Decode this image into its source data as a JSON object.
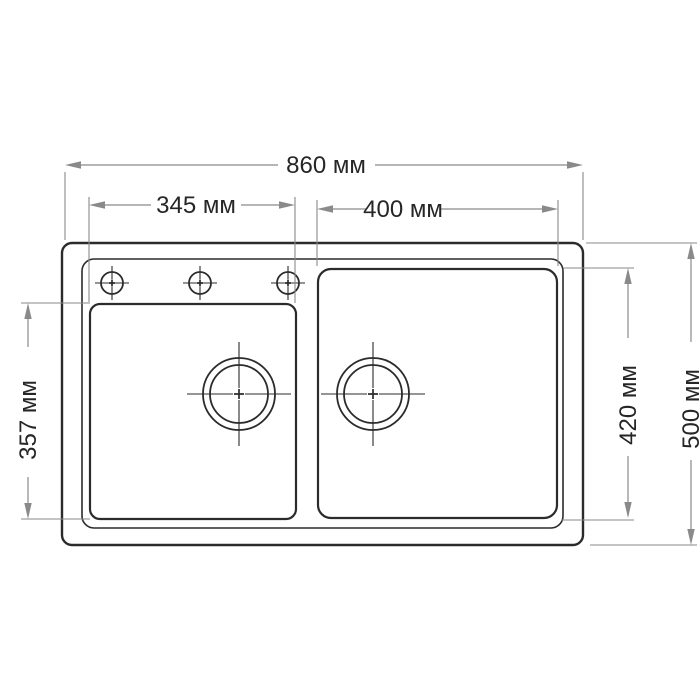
{
  "diagram": {
    "type": "technical-drawing",
    "subject": "double-bowl kitchen sink, top view with dimensions",
    "unit": "мм",
    "dimensions": {
      "overall_width": {
        "label": "860 мм",
        "value": 860
      },
      "left_bowl_width": {
        "label": "345 мм",
        "value": 345
      },
      "right_bowl_width": {
        "label": "400 мм",
        "value": 400
      },
      "left_bowl_depth": {
        "label": "357 мм",
        "value": 357
      },
      "right_bowl_depth": {
        "label": "420 мм",
        "value": 420
      },
      "overall_depth": {
        "label": "500 мм",
        "value": 500
      }
    },
    "features": {
      "bowls": 2,
      "faucet_holes": 3,
      "drains": 2
    }
  },
  "colors": {
    "line": "#2b2b2b",
    "dimension": "#8a8a8a",
    "text": "#262626",
    "bg": "#ffffff"
  }
}
